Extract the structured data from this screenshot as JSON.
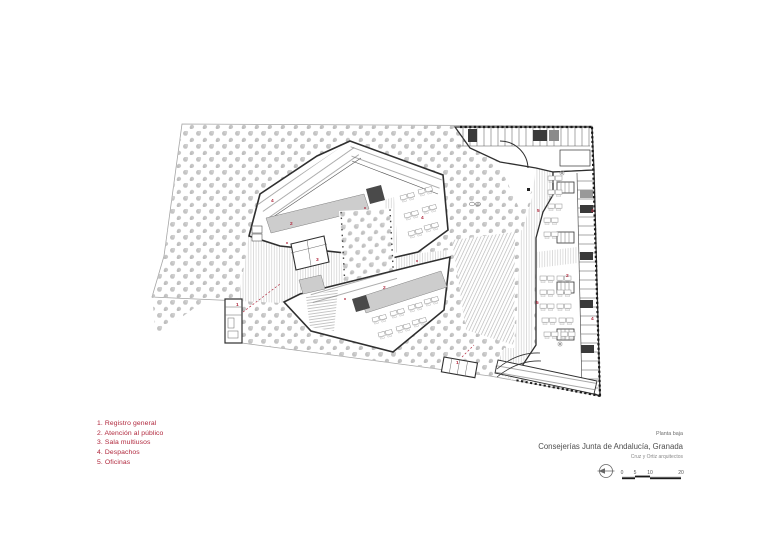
{
  "page": {
    "background": "#ffffff"
  },
  "legend": {
    "color": "#b0273c",
    "items": [
      "1. Registro general",
      "2. Atención al público",
      "3. Sala multiusos",
      "4. Despachos",
      "5. Oficinas"
    ]
  },
  "title_block": {
    "floor_label": "Planta baja",
    "project_title": "Consejerías Junta de Andalucía, Granada",
    "architects": "Cruz y Ortiz arquitectos"
  },
  "scale_bar": {
    "ticks": [
      "0",
      "5",
      "10",
      "20"
    ],
    "north_icon": "north-arrow-icon"
  },
  "plan": {
    "colors": {
      "red": "#b0273c",
      "wall": "#2f2f2f",
      "tree": "#c5c5c5",
      "gray_fill": "#cdcdcd",
      "hatch": "#bdbdbd"
    },
    "room_labels": [
      {
        "n": "4",
        "x": 271,
        "y": 202
      },
      {
        "n": "2",
        "x": 290,
        "y": 225
      },
      {
        "n": "4",
        "x": 421,
        "y": 219
      },
      {
        "n": "3",
        "x": 316,
        "y": 261
      },
      {
        "n": "2",
        "x": 383,
        "y": 289
      },
      {
        "n": "1",
        "x": 236,
        "y": 306
      },
      {
        "n": "1",
        "x": 456,
        "y": 364
      },
      {
        "n": "5",
        "x": 537,
        "y": 212
      },
      {
        "n": "5",
        "x": 536,
        "y": 304
      },
      {
        "n": "2",
        "x": 566,
        "y": 277
      },
      {
        "n": "4",
        "x": 591,
        "y": 212
      },
      {
        "n": "4",
        "x": 591,
        "y": 320
      }
    ]
  }
}
